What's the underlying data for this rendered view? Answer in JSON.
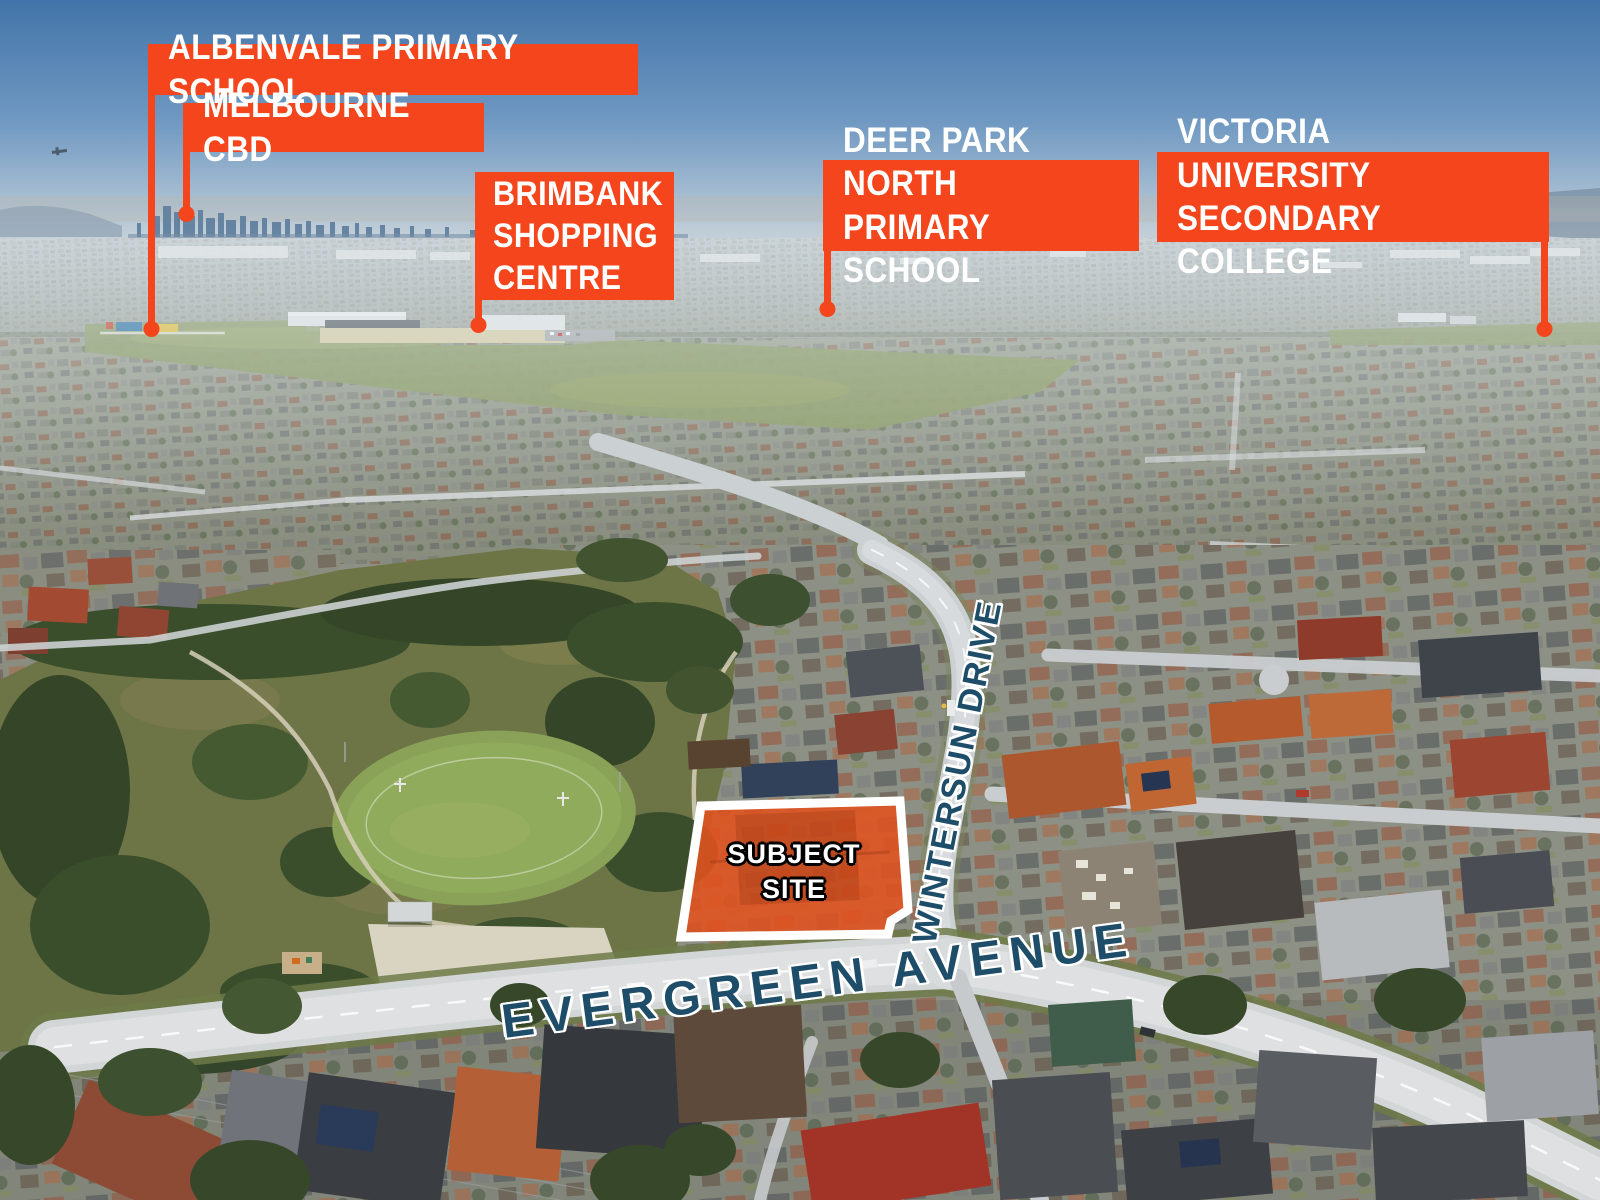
{
  "image_type": "aerial locality marketing photo",
  "colors": {
    "callout_orange": "#F4451C",
    "road_label_blue": "#1D4D68",
    "site_fill": "#E2521F",
    "site_outline": "#FFFFFF",
    "sky_top": "#4274A9",
    "sky_horizon": "#C9D3D9"
  },
  "callouts": {
    "albenvale": {
      "label": "ALBENVALE PRIMARY SCHOOL"
    },
    "melbourne_cbd": {
      "label": "MELBOURNE CBD"
    },
    "brimbank": {
      "label": "BRIMBANK\nSHOPPING\nCENTRE"
    },
    "deer_park": {
      "label": "DEER PARK NORTH\nPRIMARY SCHOOL"
    },
    "victoria_uni": {
      "label": "VICTORIA UNIVERSITY\nSECONDARY COLLEGE"
    }
  },
  "roads": {
    "wintersun": {
      "label": "WINTERSUN DRIVE"
    },
    "evergreen": {
      "label": "EVERGREEN AVENUE"
    }
  },
  "site": {
    "label": "SUBJECT\nSITE"
  }
}
